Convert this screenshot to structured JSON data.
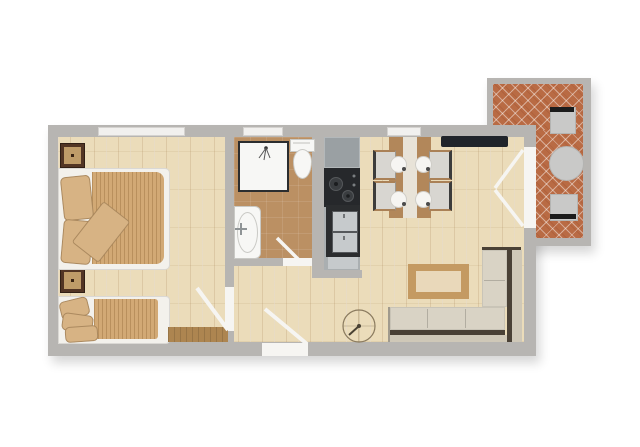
{
  "colors": {
    "page_bg": "#ffffff",
    "wall": "#b7b5b2",
    "wood": "#ebdcba",
    "bath_floor": "#bb9063",
    "brick": "#b96b44",
    "window": "#f1f0ee",
    "door_leaf": "#f6f5f2",
    "mattress": "#f3f1ec",
    "blanket": "#d2a975",
    "pillow": "#d7b384",
    "nightstand_outer": "#523524",
    "nightstand_inner": "#bf9c69",
    "mat": "#ad8550",
    "white_fixture": "#f7f7f5",
    "dark_frame": "#2b2d2f",
    "counter": "#aaafb1",
    "counter_top_seg": "#9aa0a3",
    "cooktop": "#26282b",
    "appliance_door": "#c6cacc",
    "table_wood": "#b2875a",
    "runner": "#e8e3d8",
    "chair_seat": "#d8d6d1",
    "plate": "#f6f5f2",
    "sofa_seat": "#d9d3c5",
    "sofa_back": "#cfc8b8",
    "sofa_gap": "#4a4136",
    "coffee_frame": "#c49a62",
    "coffee_top": "#e9d8ba",
    "tv": "#20242a",
    "terrace_item": "#c9c9c8",
    "terrace_item_dark": "#1c1c1c"
  },
  "plan": {
    "rooms": [
      "bedroom",
      "bathroom",
      "kitchen",
      "dining-area",
      "living-room",
      "hallway",
      "terrace"
    ],
    "furniture": [
      "double-bed",
      "single-bed",
      "nightstand",
      "wall-mat",
      "shower",
      "toilet",
      "sink",
      "kitchen-counter",
      "cooktop",
      "oven-stack",
      "dining-table",
      "dining-chair",
      "plate",
      "corner-sofa",
      "coffee-table",
      "tv-sideboard",
      "compass-rose",
      "terrace-table",
      "terrace-chair",
      "entrance-door",
      "interior-door",
      "french-doors",
      "window"
    ]
  }
}
